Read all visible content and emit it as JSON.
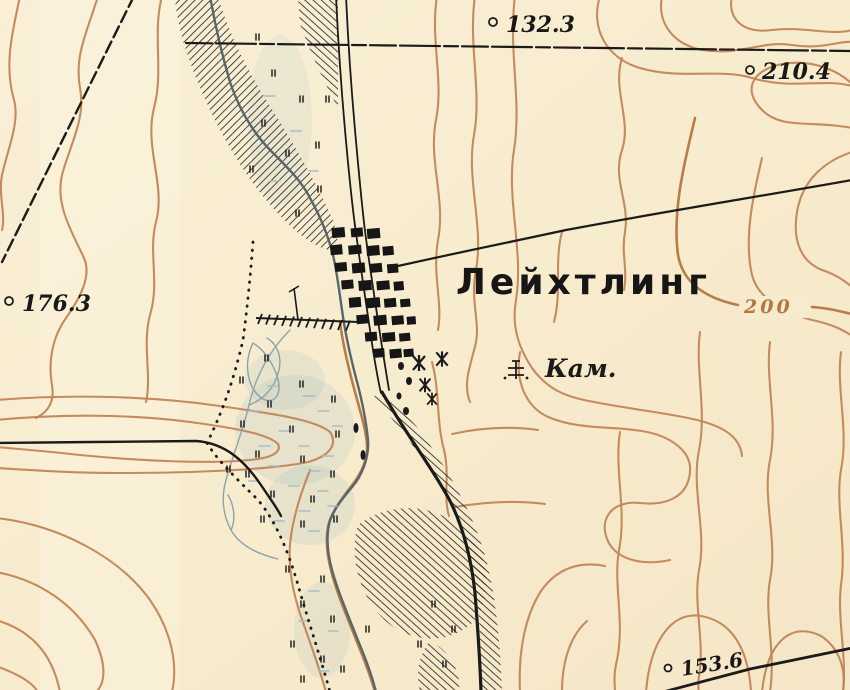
{
  "map": {
    "settlement_label": "Лейхтлинг",
    "kam_label": "Кам.",
    "contour_elevation_label": "200",
    "spot_heights": {
      "north": "132.3",
      "northeast": "210.4",
      "west": "176.3",
      "southeast": "153.6"
    },
    "colors": {
      "paper": "#f8eed3",
      "contour_brown": "#c08252",
      "river_blue": "#57666d",
      "marsh_blue": "#a3bfc9",
      "ink_black": "#1b1b1b"
    }
  }
}
